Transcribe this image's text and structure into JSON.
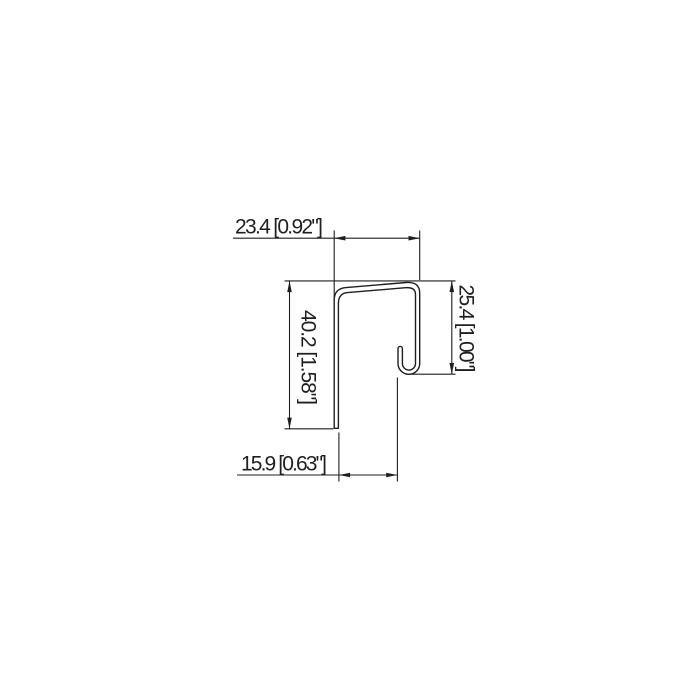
{
  "page": {
    "background": "#ffffff"
  },
  "drawing": {
    "kind": "sheet-metal trim profile cross-section, dimensioned technical drawing",
    "units": "millimeters [inches]",
    "line_color": "#1f1f1f",
    "dimensions": {
      "top_width": {
        "label": "23.4 [0.92\"]",
        "mm": "23.4",
        "inch": "0.92\""
      },
      "left_height": {
        "label": "40.2 [1.58\"]",
        "mm": "40.2",
        "inch": "1.58\""
      },
      "right_height": {
        "label": "25.4 [1.00\"]",
        "mm": "25.4",
        "inch": "1.00\""
      },
      "bottom_width": {
        "label": "15.9 [0.63\"]",
        "mm": "15.9",
        "inch": "0.63\""
      }
    }
  }
}
